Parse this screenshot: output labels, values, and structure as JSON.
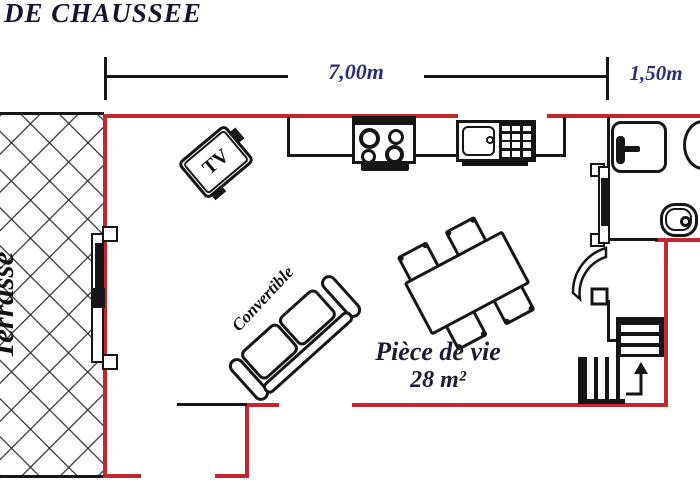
{
  "header": {
    "title": "DE CHAUSSEE"
  },
  "dimensions": {
    "main_width": "7,00m",
    "right_width": "1,50m"
  },
  "rooms": {
    "terrace_label": "Terrasse",
    "living_name": "Pièce de vie",
    "living_area": "28 m²"
  },
  "furniture": {
    "tv_label": "TV",
    "sofa_label": "Convertible"
  },
  "colors": {
    "wall": "#c0272e",
    "line": "#161616",
    "title": "#141432",
    "dim": "#2d2d7a",
    "room": "#1b1b33"
  }
}
